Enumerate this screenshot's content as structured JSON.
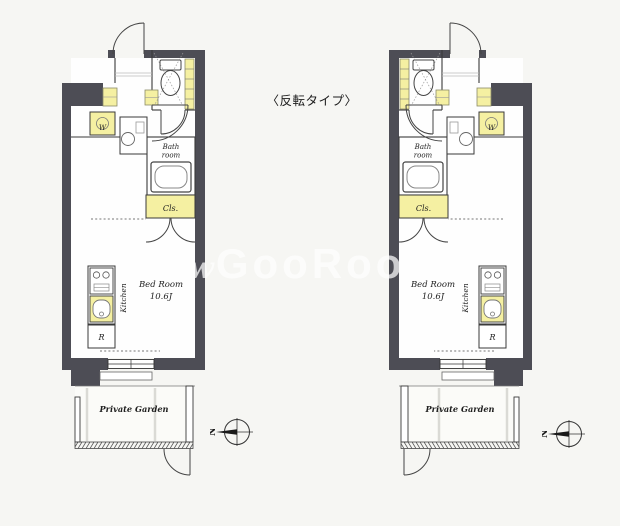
{
  "title": "〈反転タイプ〉",
  "watermark": {
    "prefix": "w",
    "text": "GooRooM"
  },
  "compass": {
    "north_label": "N"
  },
  "plans": [
    {
      "name": "left-plan",
      "labels": {
        "washer": "W",
        "bath_line1": "Bath",
        "bath_line2": "room",
        "closet": "Cls.",
        "bedroom_name": "Bed Room",
        "bedroom_size": "10.6J",
        "kitchen": "Kitchen",
        "fridge": "R",
        "garden": "Private Garden"
      }
    },
    {
      "name": "right-plan-mirrored",
      "labels": {
        "washer": "W",
        "bath_line1": "Bath",
        "bath_line2": "room",
        "closet": "Cls.",
        "bedroom_name": "Bed Room",
        "bedroom_size": "10.6J",
        "kitchen": "Kitchen",
        "fridge": "R",
        "garden": "Private Garden"
      }
    }
  ]
}
